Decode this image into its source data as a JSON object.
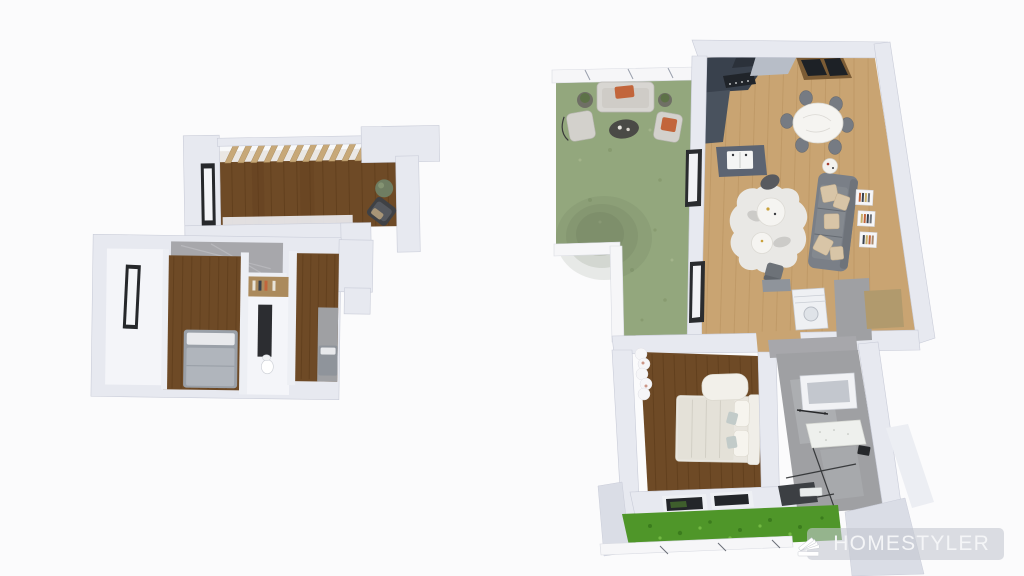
{
  "watermark": {
    "brand": "HOMESTYLER",
    "logo_icon": "homestyler-fan-logo"
  },
  "scene": {
    "description": "3D top-down render of a two-storey home design, exported with brand watermark",
    "floors": [
      {
        "id": "upper-floor",
        "position": "left",
        "rooms": [
          "terrace-with-pergola",
          "bedroom-1",
          "bedroom-2",
          "gray-marble-closet",
          "empty-room",
          "media-nook"
        ],
        "furniture": [
          "potted-plant",
          "lounge-chair",
          "gray-double-bed",
          "gray-single-bed",
          "dark-wall-panel",
          "wood-shelf",
          "toilet"
        ]
      },
      {
        "id": "ground-floor",
        "position": "right",
        "rooms": [
          "garden-patio",
          "living-room",
          "kitchen",
          "dining-area",
          "bedroom",
          "bathroom",
          "laundry-hall"
        ],
        "furniture": [
          "outdoor-sofa",
          "outdoor-armchair-left",
          "outdoor-armchair-right",
          "outdoor-coffee-table",
          "planter-tables",
          "kitchen-counter",
          "kitchen-island-sink",
          "round-dining-table",
          "dining-chairs-x6",
          "gray-sofa",
          "beige-pillows",
          "cowhide-rug",
          "round-coffee-tables-x2",
          "pouf",
          "side-table",
          "wall-book-shelves-x3",
          "washing-machine",
          "cream-double-bed",
          "ottoman",
          "curtains",
          "wall-cabinet",
          "vanity-counter",
          "shower-glass",
          "dark-sink-counter"
        ]
      }
    ]
  },
  "palette": {
    "background": "#fbfbfc",
    "wall": "#e7e9f0",
    "wall_edge": "#c9ccd8",
    "wall_deep": "#dadde6",
    "floor_white": "#f4f5f9",
    "wood_dark": "#6e4a26",
    "wood_plank_line": "#4e2f10",
    "oak": "#c9a472",
    "oak_line": "#a9834f",
    "garden_green": "#93a77d",
    "grass_green": "#4f9629",
    "tile_gray": "#9fa0a3",
    "marble_gray": "#a7a7ab",
    "counter_dark": "#39414d",
    "steel_gray": "#b7bdc7",
    "island_gray": "#5c6472",
    "sofa_gray": "#7a7f87",
    "pillow_beige": "#d8c5a7",
    "accent_orange": "#c2653b",
    "bed_cream": "#e9e6df",
    "bed_gray": "#9aa0a8",
    "rug_white": "#e9e8e5",
    "skylight_frame": "#7c5c35",
    "glass_dark": "#1d2126",
    "tan_closet": "#b19a6d",
    "watermark_bg": "rgba(197,200,209,0.6)",
    "watermark_text": "#f4f5f7"
  }
}
